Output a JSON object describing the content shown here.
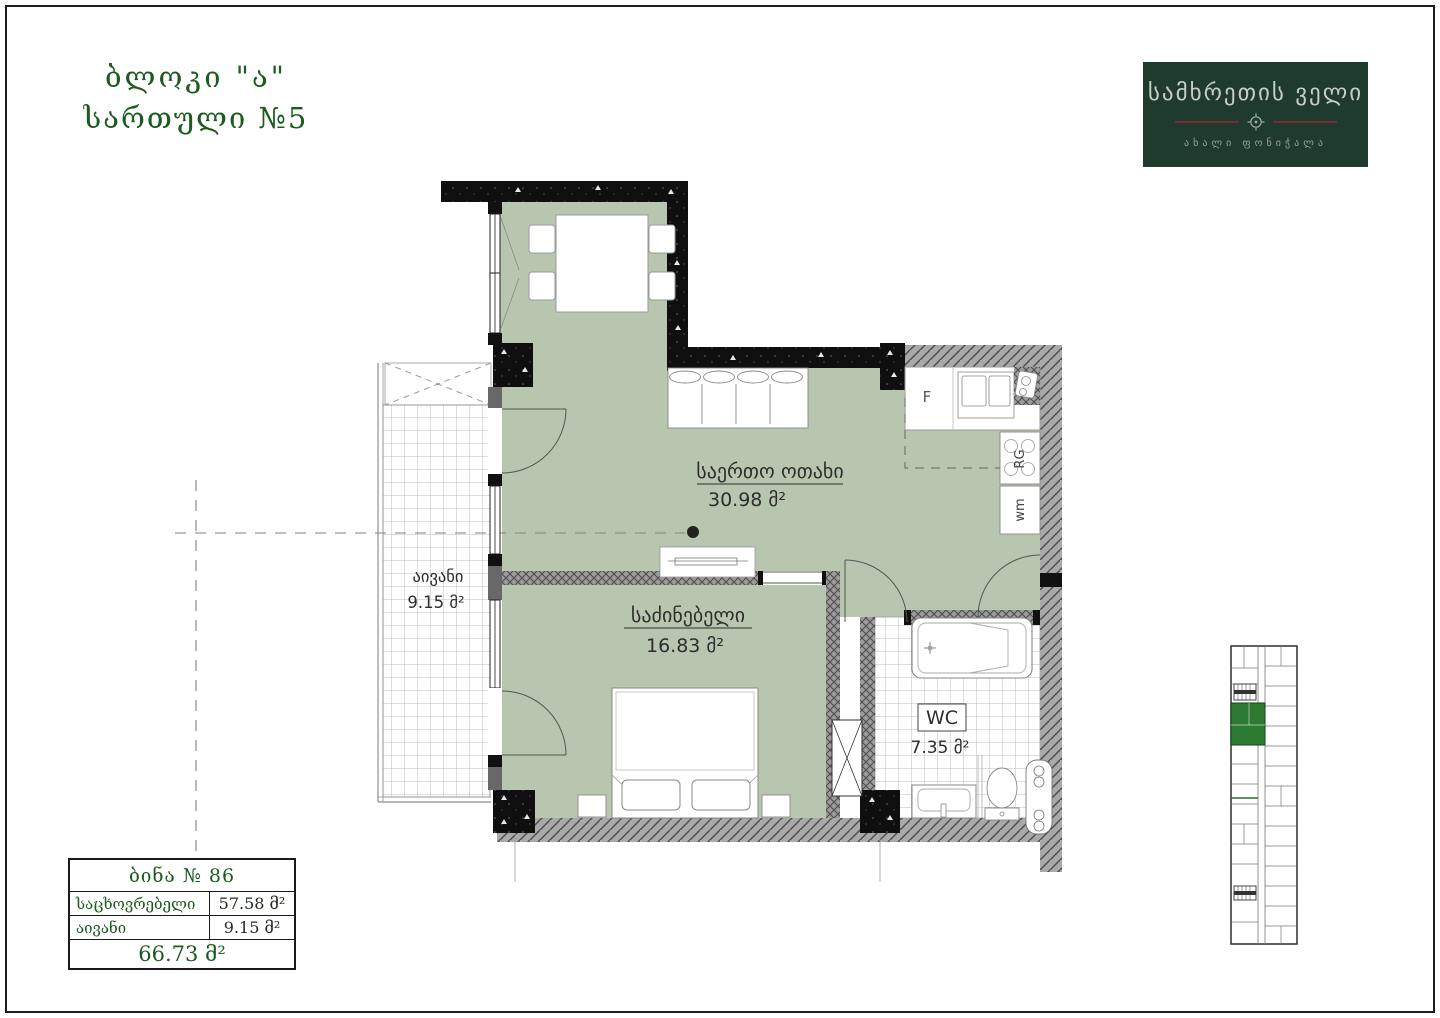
{
  "header": {
    "block": "ბლოკი \"ა\"",
    "floor": "სართული №5"
  },
  "logo": {
    "brand": "სამხრეთის ველი",
    "tagline": "ახალი ფონიჭალა"
  },
  "plan": {
    "living": {
      "name": "საერთო ოთახი",
      "area": "30.98 მ²"
    },
    "bedroom": {
      "name": "საძინებელი",
      "area": "16.83 მ²"
    },
    "balcony": {
      "name": "აივანი",
      "area": "9.15 მ²"
    },
    "wc": {
      "name": "WC",
      "area": "7.35 მ²"
    },
    "kitchen": {
      "fridge": "F",
      "range": "RG",
      "washer": "wm"
    }
  },
  "summary": {
    "title": "ბინა № 86",
    "rows": [
      {
        "label": "საცხოვრებელი",
        "value": "57.58 მ²"
      },
      {
        "label": "აივანი",
        "value": "9.15 მ²"
      }
    ],
    "total": "66.73 მ²"
  },
  "colors": {
    "room_fill": "#b8c6b0",
    "brand_bg": "#1e3b2d",
    "accent_red": "#7c2b2e",
    "heading_green": "#1c5a20",
    "minimap_unit": "#2d7a33"
  }
}
